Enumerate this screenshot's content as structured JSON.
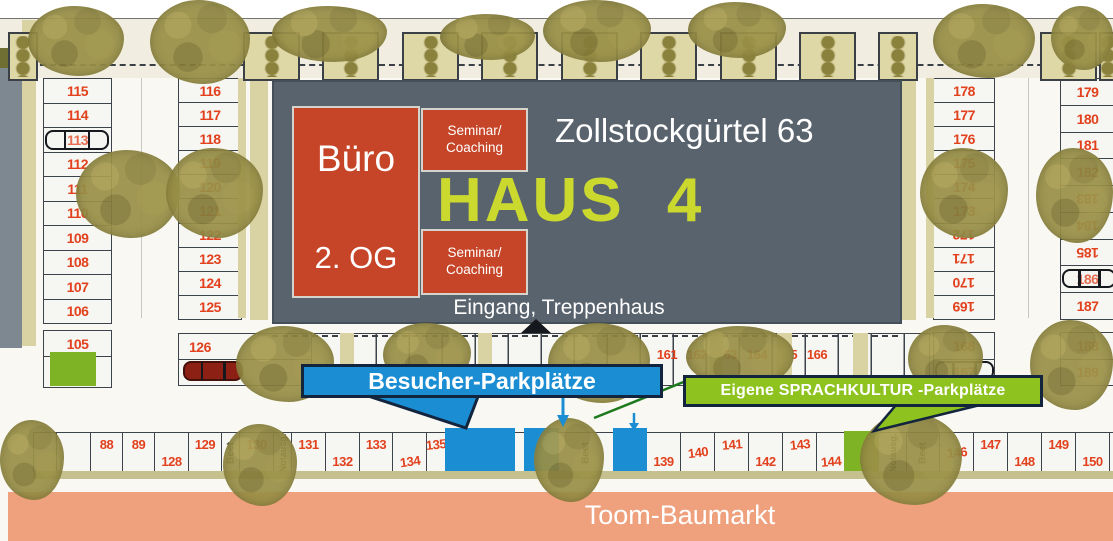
{
  "map": {
    "building_sign": {
      "office_label": "Büro",
      "office_floor": "2. OG",
      "seminar_top": {
        "line1": "Seminar/",
        "line2": "Coaching"
      },
      "seminar_bottom": {
        "line1": "Seminar/",
        "line2": "Coaching"
      },
      "street_address": "Zollstockgürtel 63",
      "house_label": "HAUS 4",
      "entrance_label": "Eingang, Treppenhaus"
    },
    "callouts": {
      "visitor_label": "Besucher-Parkplätze",
      "own_label": "Eigene SPRACHKULTUR -Parkplätze"
    },
    "store_bar_label": "Toom-Baumarkt",
    "landscape_labels": {
      "bed": "Beet",
      "emergency_exit": "Notausg."
    },
    "parking": {
      "col_left_outer": [
        "115",
        "114",
        "113",
        "112",
        "111",
        "110",
        "109",
        "108",
        "107",
        "106"
      ],
      "col_left_outer_lower": [
        "105"
      ],
      "col_left_inner": [
        "116",
        "117",
        "118",
        "119",
        "120",
        "121",
        "122",
        "123",
        "124",
        "125"
      ],
      "mid_left_pair": [
        "126",
        "127"
      ],
      "mid_right_row": [
        "161",
        "162",
        "163",
        "164",
        "165",
        "166"
      ],
      "col_right_inner": [
        "178",
        "177",
        "176",
        "175",
        "174",
        "173",
        "172",
        "171",
        "170",
        "169"
      ],
      "col_right_inner_lower": [
        "168",
        "167"
      ],
      "col_right_outer": [
        "179",
        "180",
        "181",
        "182",
        "183",
        "184",
        "185",
        "186",
        "187"
      ],
      "col_right_outer_lower": [
        "188",
        "189"
      ],
      "bottom_row": [
        {
          "label": "",
          "style": "empty"
        },
        {
          "label": "",
          "style": "empty"
        },
        {
          "label": "88",
          "style": "high"
        },
        {
          "label": "89",
          "style": "high"
        },
        {
          "label": "128",
          "style": "low"
        },
        {
          "label": "129",
          "style": "high"
        },
        {
          "label": "Beet",
          "style": "beet"
        },
        {
          "label": "130",
          "style": "tree-high"
        },
        {
          "label": "Notausg.",
          "style": "notausg"
        },
        {
          "label": "131",
          "style": "high"
        },
        {
          "label": "132",
          "style": "low"
        },
        {
          "label": "133",
          "style": "high"
        },
        {
          "label": "134",
          "style": "low"
        },
        {
          "label": "135",
          "style": "high"
        },
        {
          "label": "",
          "style": "blue"
        },
        {
          "label": "",
          "style": "blue"
        },
        {
          "label": "",
          "style": "empty"
        },
        {
          "label": "",
          "style": "blue"
        },
        {
          "label": "Beet",
          "style": "beet-tree"
        },
        {
          "label": "",
          "style": "blue"
        },
        {
          "label": "139",
          "style": "low"
        },
        {
          "label": "140",
          "style": "mid"
        },
        {
          "label": "141",
          "style": "high"
        },
        {
          "label": "142",
          "style": "low"
        },
        {
          "label": "143",
          "style": "high"
        },
        {
          "label": "144",
          "style": "low"
        },
        {
          "label": "",
          "style": "green"
        },
        {
          "label": "Notausg.",
          "style": "notausg"
        },
        {
          "label": "Beet",
          "style": "beet-tree"
        },
        {
          "label": "146",
          "style": "tree-mid"
        },
        {
          "label": "147",
          "style": "high"
        },
        {
          "label": "148",
          "style": "low"
        },
        {
          "label": "149",
          "style": "high"
        },
        {
          "label": "150",
          "style": "low"
        },
        {
          "label": "151",
          "style": "high"
        },
        {
          "label": "152",
          "style": "high"
        }
      ]
    },
    "colors": {
      "visitor_blue": "#1b8ed3",
      "own_green": "#8dc21f",
      "space_green": "#7db324",
      "callout_border_navy": "#12243e",
      "sign_slate": "#59636d",
      "sign_red": "#c64427",
      "haus_yellow_green": "#cbd92f",
      "number_red": "#e2411e",
      "store_bar_salmon": "#efa07c",
      "tan_path": "#d9d3a3"
    }
  }
}
